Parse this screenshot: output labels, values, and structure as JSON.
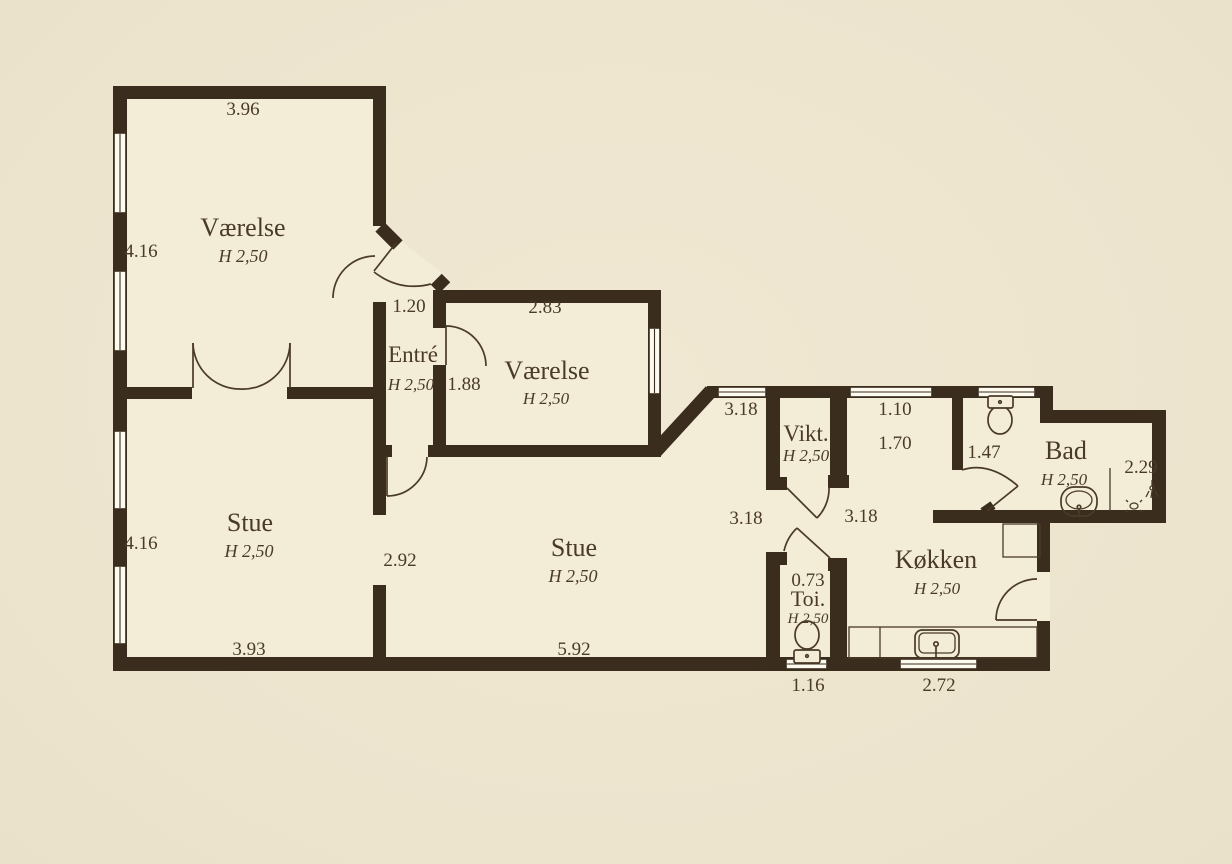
{
  "colors": {
    "background": "#ece4cd",
    "paper": "#f3ecd7",
    "wall": "#3a2d1d",
    "text": "#4a3a28",
    "window_fill": "#fdfaf0"
  },
  "rooms": {
    "vaerelse1": {
      "label": "Værelse",
      "ceiling": "H 2,50",
      "dim_top": "3.96",
      "dim_left": "4.16"
    },
    "entre": {
      "label": "Entré",
      "ceiling": "H 2,50",
      "dim_passage": "1.20",
      "dim_width": "1.88"
    },
    "vaerelse2": {
      "label": "Værelse",
      "ceiling": "H 2,50",
      "dim_top": "2.83"
    },
    "stue_left": {
      "label": "Stue",
      "ceiling": "H 2,50",
      "dim_left": "4.16",
      "dim_bottom": "3.93",
      "dim_opening": "2.92"
    },
    "stue_main": {
      "label": "Stue",
      "ceiling": "H 2,50",
      "dim_bottom": "5.92",
      "dim_top": "3.18",
      "dim_right": "3.18"
    },
    "vikt": {
      "label": "Vikt.",
      "ceiling": "H 2,50"
    },
    "toi": {
      "label": "Toi.",
      "ceiling": "H 2,50",
      "dim_width": "0.73",
      "dim_bottom": "1.16"
    },
    "kokken": {
      "label": "Køkken",
      "ceiling": "H 2,50",
      "dim_win_top": "1.10",
      "dim_top": "1.70",
      "dim_left": "3.18",
      "dim_bottom": "2.72"
    },
    "bad": {
      "label": "Bad",
      "ceiling": "H 2,50",
      "dim_door": "1.47",
      "dim_right": "2.29"
    }
  }
}
